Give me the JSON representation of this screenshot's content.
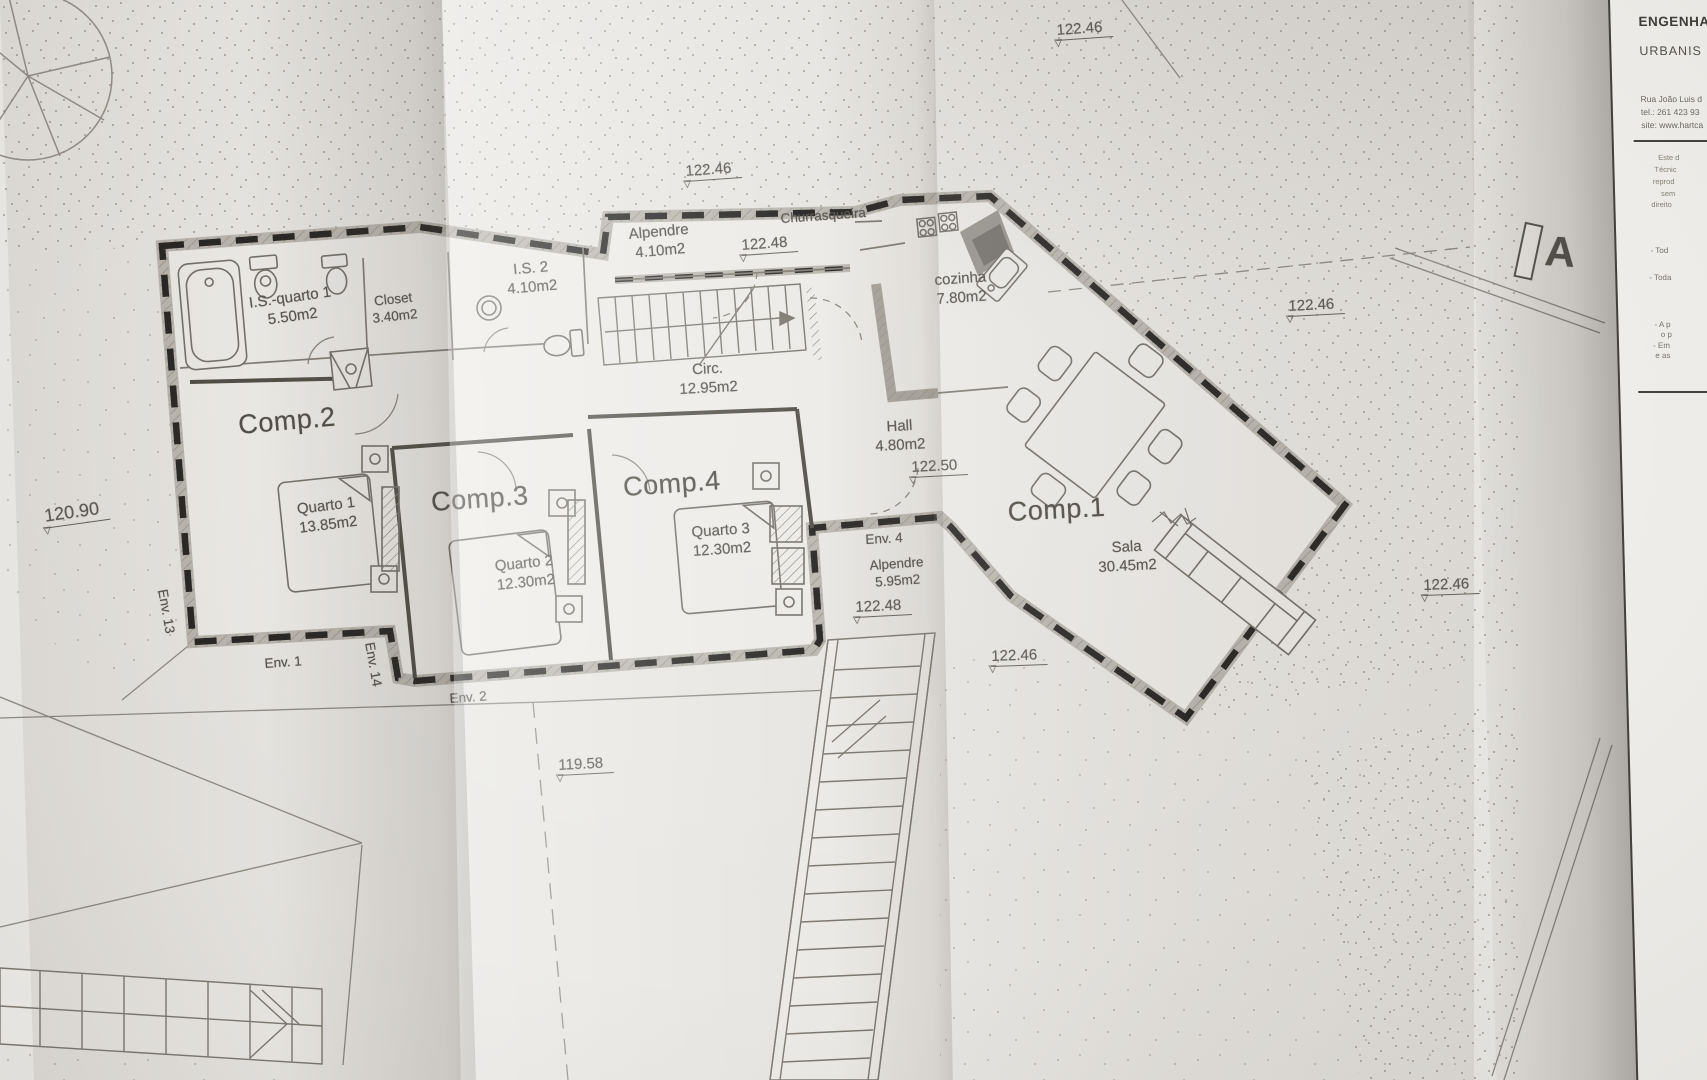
{
  "titleblock": {
    "company_line1": "ENGENHA",
    "company_line2": "URBANIS",
    "address": [
      "Rua João Luis d",
      "tel.: 261 423 93",
      "site: www.hartca"
    ],
    "disclaimer": [
      "Este d",
      "Técnic",
      "reprod",
      "sem",
      "direito"
    ],
    "notes": [
      "- Tod",
      "- Toda",
      "- A p",
      "o p",
      "- Em",
      "e as"
    ]
  },
  "section_marker": {
    "label": "A"
  },
  "levels": {
    "top_center": "122.46",
    "upper_mid": "122.46",
    "alpendre_top": "122.48",
    "right_mid": "122.46",
    "hall": "122.50",
    "env4": "122.48",
    "right_low": "122.46",
    "stair": "122.46",
    "left": "120.90",
    "lower": "119.58"
  },
  "rooms": {
    "comp1": {
      "label": "Comp.1"
    },
    "comp2": {
      "label": "Comp.2"
    },
    "comp3": {
      "label": "Comp.3"
    },
    "comp4": {
      "label": "Comp.4"
    },
    "sala": {
      "name": "Sala",
      "area": "30.45m2"
    },
    "cozinha": {
      "name": "cozinha",
      "area": "7.80m2"
    },
    "hall": {
      "name": "Hall",
      "area": "4.80m2"
    },
    "circ": {
      "name": "Circ.",
      "area": "12.95m2"
    },
    "alpendre_top": {
      "name": "Alpendre",
      "area": "4.10m2"
    },
    "alpendre_side": {
      "name": "Alpendre",
      "area": "5.95m2"
    },
    "churrasqueira": {
      "name": "Churrasqueira"
    },
    "is2": {
      "name": "I.S. 2",
      "area": "4.10m2"
    },
    "is_quarto1": {
      "name": "I.S.-quarto 1",
      "area": "5.50m2"
    },
    "closet": {
      "name": "Closet",
      "area": "3.40m2"
    },
    "quarto1": {
      "name": "Quarto 1",
      "area": "13.85m2"
    },
    "quarto2": {
      "name": "Quarto 2",
      "area": "12.30m2"
    },
    "quarto3": {
      "name": "Quarto 3",
      "area": "12.30m2"
    }
  },
  "envelopes": {
    "env1": {
      "label": "Env. 1"
    },
    "env2": {
      "label": "Env. 2"
    },
    "env4": {
      "label": "Env. 4"
    },
    "env13": {
      "label": "Env. 13"
    },
    "env14": {
      "label": "Env. 14"
    }
  }
}
